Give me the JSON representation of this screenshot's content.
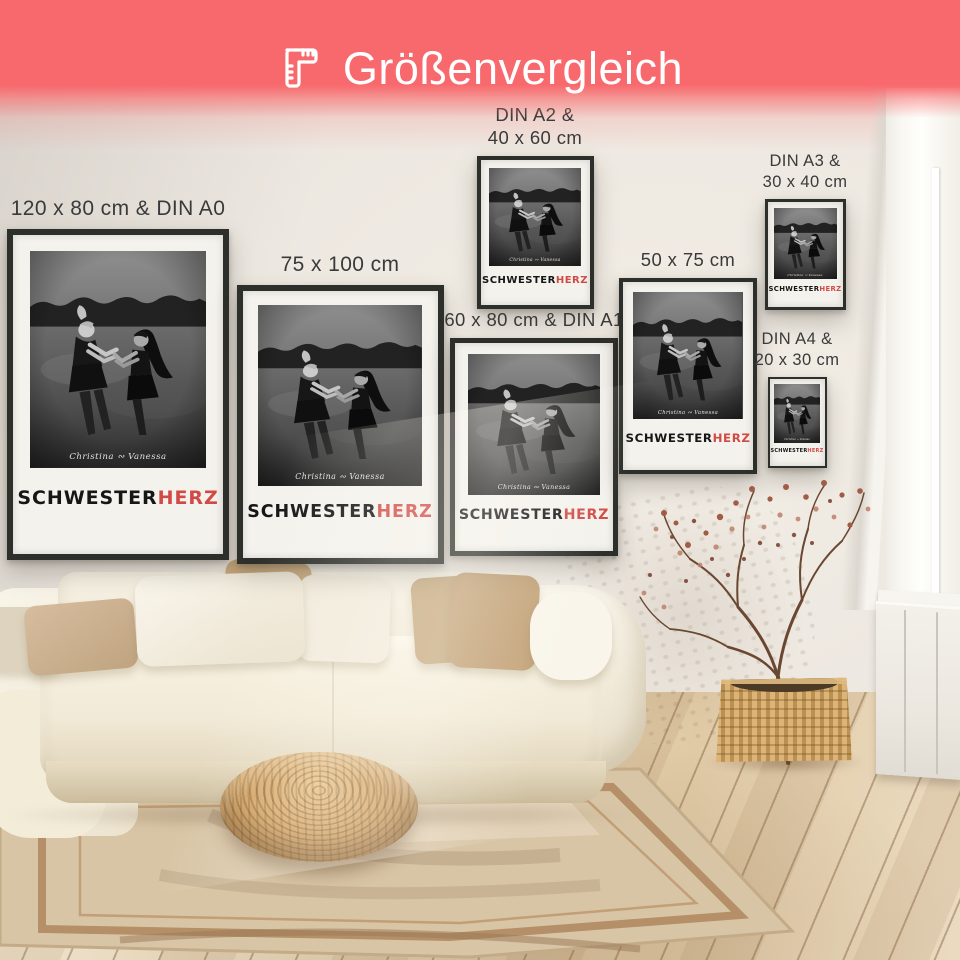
{
  "header": {
    "title": "Größenvergleich",
    "icon": "ruler-icon",
    "background_color": "#f8696d",
    "text_color": "#ffffff"
  },
  "posters": [
    {
      "id": "120x80-din-a0",
      "label": "120 x 80 cm & DIN A0"
    },
    {
      "id": "75x100",
      "label": "75 x 100 cm"
    },
    {
      "id": "60x80-din-a1",
      "label": "60 x 80 cm & DIN A1"
    },
    {
      "id": "din-a2-40x60",
      "label": "DIN A2 &\n40 x 60 cm"
    },
    {
      "id": "50x75",
      "label": "50 x 75 cm"
    },
    {
      "id": "din-a3-30x40",
      "label": "DIN A3 &\n30 x 40 cm"
    },
    {
      "id": "din-a4-20x30",
      "label": "DIN A4 &\n20 x 30 cm"
    }
  ],
  "poster_content": {
    "names": "Christina ∾ Vanessa",
    "title_black": "SCHWESTER",
    "title_red": "HERZ",
    "title_red_color": "#d24a45",
    "frame_color": "#2d2f2b"
  }
}
